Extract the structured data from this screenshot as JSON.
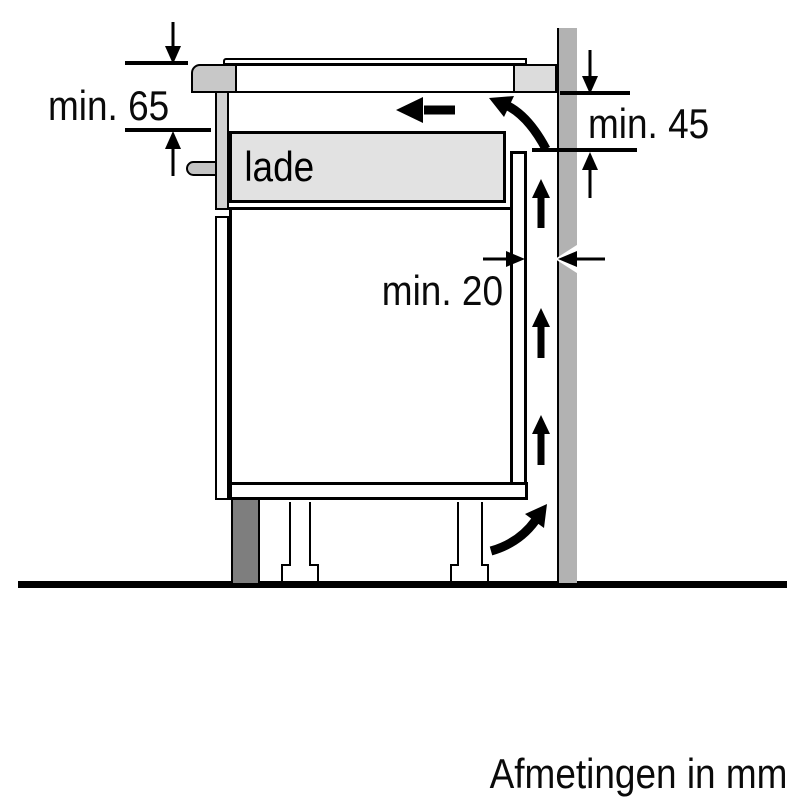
{
  "diagram": {
    "type": "appliance-installation-side-view",
    "dimensions": {
      "hob_depth_label": "min. 65",
      "wall_clearance_label": "min. 45",
      "rear_gap_label": "min. 20"
    },
    "labels": {
      "drawer": "lade",
      "footer": "Afmetingen in mm"
    },
    "colors": {
      "background": "#ffffff",
      "line": "#000000",
      "wall": "#b2b2b2",
      "worktop_left_block": "#c8c8c8",
      "worktop_right_block": "#dcdcdc",
      "hob_side_strip": "#d2d2d2",
      "drawer_fill": "#e2e2e2",
      "plinth": "#7e7e7e"
    },
    "icons": [
      "dimension-down-arrow-icon",
      "dimension-up-arrow-icon",
      "dimension-right-arrow-icon",
      "dimension-left-arrow-icon",
      "airflow-left-arrow-icon",
      "airflow-curved-top-arrow-icon",
      "airflow-up-arrow-icon",
      "airflow-curved-bottom-arrow-icon"
    ]
  }
}
